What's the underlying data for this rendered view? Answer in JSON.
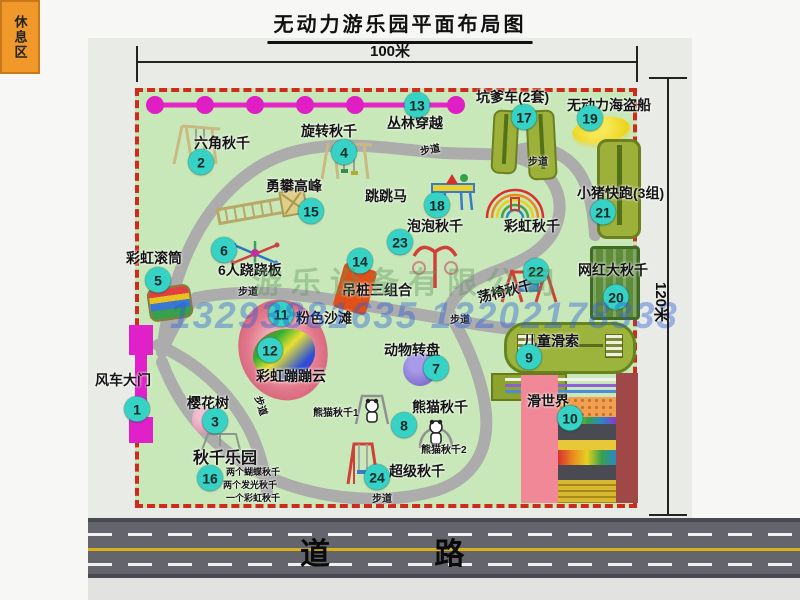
{
  "title": "无动力游乐园平面布局图",
  "dimensions": {
    "top": "100米",
    "right": "120米"
  },
  "road": {
    "label": "道 路"
  },
  "park": {
    "path_label": "步道",
    "rest_area": "休息区",
    "rainbow_swing": "彩虹秋千",
    "panda_swing_1": "熊猫秋千1",
    "panda_swing_2": "熊猫秋千2"
  },
  "swing_park_details": [
    "两个蝴蝶秋千",
    "两个发光秋千",
    "一个彩虹秋千"
  ],
  "watermark": {
    "company": "游乐设备有限公司",
    "phone": "13293881635 13202178333"
  },
  "attractions": [
    {
      "num": "1",
      "label": "风车大门"
    },
    {
      "num": "2",
      "label": "六角秋千"
    },
    {
      "num": "3",
      "label": "樱花树"
    },
    {
      "num": "4",
      "label": "旋转秋千"
    },
    {
      "num": "5",
      "label": "彩虹滚筒"
    },
    {
      "num": "6",
      "label": "6人跷跷板"
    },
    {
      "num": "7",
      "label": "动物转盘"
    },
    {
      "num": "8",
      "label": "熊猫秋千"
    },
    {
      "num": "9",
      "label": "儿童滑索"
    },
    {
      "num": "10",
      "label": "滑世界"
    },
    {
      "num": "11",
      "label": "粉色沙滩"
    },
    {
      "num": "12",
      "label": "彩虹蹦蹦云"
    },
    {
      "num": "13",
      "label": "丛林穿越"
    },
    {
      "num": "14",
      "label": "吊桩三组合"
    },
    {
      "num": "15",
      "label": "勇攀高峰"
    },
    {
      "num": "16",
      "label": "秋千乐园"
    },
    {
      "num": "17",
      "label": "坑爹车(2套)"
    },
    {
      "num": "18",
      "label": "跳跳马"
    },
    {
      "num": "19",
      "label": "无动力海盗船"
    },
    {
      "num": "20",
      "label": "网红大秋千"
    },
    {
      "num": "21",
      "label": "小猪快跑(3组)"
    },
    {
      "num": "22",
      "label": "荡椅秋千"
    },
    {
      "num": "23",
      "label": "泡泡秋千"
    },
    {
      "num": "24",
      "label": "超级秋千"
    }
  ]
}
